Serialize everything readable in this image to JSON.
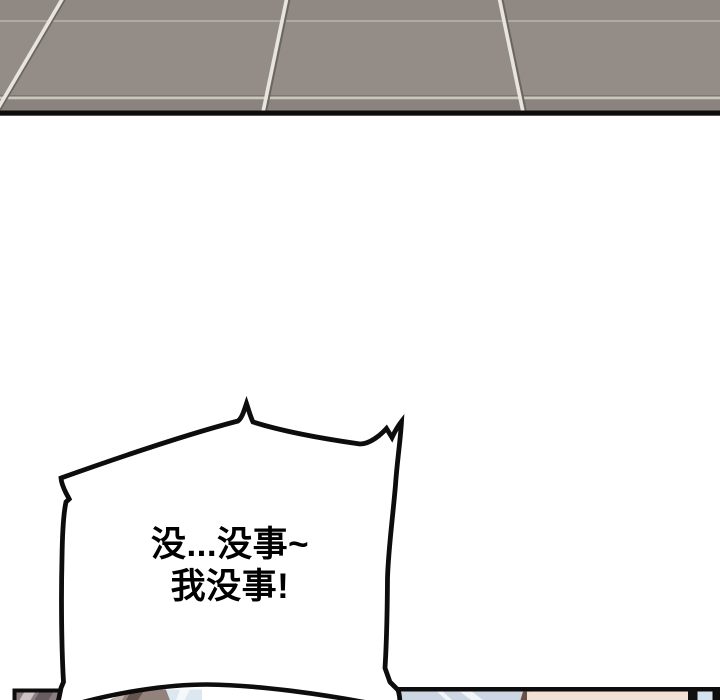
{
  "page": {
    "background": "#ffffff"
  },
  "floor_panel": {
    "tile_color": "#948d87",
    "tile_color_top": "#908983",
    "tile_color_bottom": "#8b847e",
    "grout_light": "#e8e5e1",
    "grout_shadow": "#6b665f",
    "grout_horizontal_faint": "#b5afa8",
    "grout_horizontal_low": "#cbc6c0",
    "border_color": "#0d0d0d"
  },
  "speech_bubble": {
    "fill": "#ffffff",
    "outline": "#0d0d0d",
    "text_color": "#000000",
    "line1": "没...没事~",
    "line2": "我没事!"
  },
  "next_panel": {
    "left_fragment": {
      "base": "#8a7f82",
      "streak_light": "#cdc3c4",
      "streak_dark": "#675c5f",
      "border": "#0d0d0d"
    },
    "right_fragment": {
      "border": "#0d0d0d",
      "blue_gray": "#ccd7e3",
      "streak_white": "#f2f6f9",
      "dark_edge": "#6b5048",
      "skin": "#f3e1d3",
      "black_bar": "#111111",
      "blue_sliver": "#d5e1eb"
    },
    "character_head": {
      "outline": "#0d0d0d",
      "hair_brown": "#93817b",
      "hair_dark": "#64544f",
      "hair_light": "#bfb1a9",
      "hair_blue_sheen": "#dde7f0",
      "sheen_white": "#f4f8fb"
    }
  }
}
